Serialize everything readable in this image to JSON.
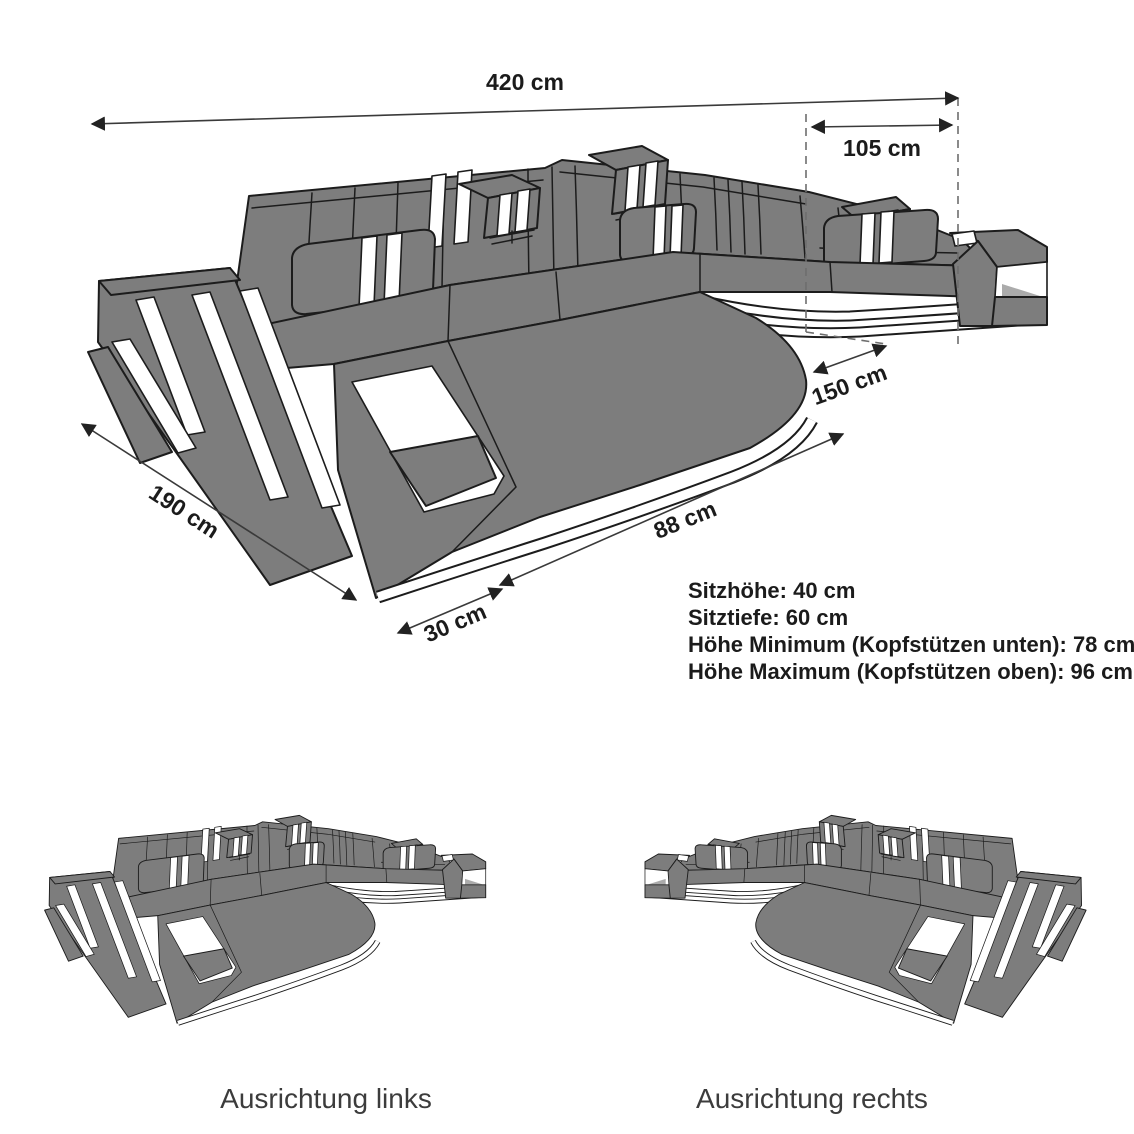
{
  "diagram": {
    "dimension_labels": {
      "total_width": "420 cm",
      "right_section_width": "105 cm",
      "inner_depth": "150 cm",
      "left_side_depth": "190 cm",
      "front_corner": "30 cm",
      "front_edge": "88 cm"
    },
    "specs": [
      "Sitzhöhe: 40 cm",
      "Sitztiefe: 60 cm",
      "Höhe Minimum (Kopfstützen unten): 78 cm",
      "Höhe Maximum (Kopfstützen oben): 96 cm"
    ],
    "variants": [
      {
        "label": "Ausrichtung links"
      },
      {
        "label": "Ausrichtung rechts"
      }
    ],
    "colors": {
      "sofa_fill": "#7d7d7d",
      "outline": "#1c1c1c",
      "accent_white": "#ffffff",
      "dimension_line": "#3a3a3a",
      "text": "#1b1b1b"
    }
  }
}
